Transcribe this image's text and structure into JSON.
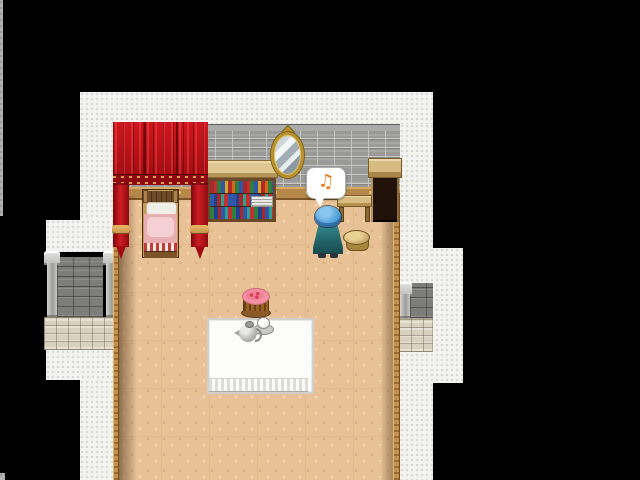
{
  "meta": {
    "app": "rpg-game-screen",
    "scene": "bedroom interior with curtained bed, viewed top-down, surrounded by white walkway and black void",
    "viewport_width": 640,
    "viewport_height": 480
  },
  "colors": {
    "background": "#000000",
    "ground_white": "#f3f3f0",
    "wall_gray": "#9a9a98",
    "floor_tan": "#e8c296",
    "curtain_red": "#b80f16",
    "gold_trim": "#c79552",
    "blanket_pink": "#e9aeb1",
    "mirror_gold": "#b8912f",
    "wardrobe_dark": "#201208",
    "desk_wood": "#d9bd83",
    "stool_wood": "#cfb274",
    "character_hair": "#4f9fd9",
    "character_robe": "#2e7d80",
    "balloon_note": "#e8791a",
    "table_white": "#fcfcfb",
    "cake_pink": "#f492a4",
    "book_colors": "red green blue yellow orange teal"
  },
  "balloon": {
    "glyph": "♫"
  },
  "objects": {
    "character": "villager with blue hair seen from behind, music balloon above",
    "bed": "wooden bed with white pillow and pink blanket",
    "curtain": "red canopy curtain with gold tiebacks",
    "bookshelf": "counter-top bookshelf with three rows of colored books",
    "mirror": "gold oval wall mirror",
    "wardrobe": "open dark wardrobe with wooden top",
    "desk": "low wooden table",
    "stool": "round wooden stool",
    "table": "white tablecloth table with fringe",
    "tea_set": "metal teapot with cup and saucer",
    "cake": "pink frosted cake on plate",
    "pillars": "stone pillar walls with cobblestone bases on left and right exterior"
  }
}
